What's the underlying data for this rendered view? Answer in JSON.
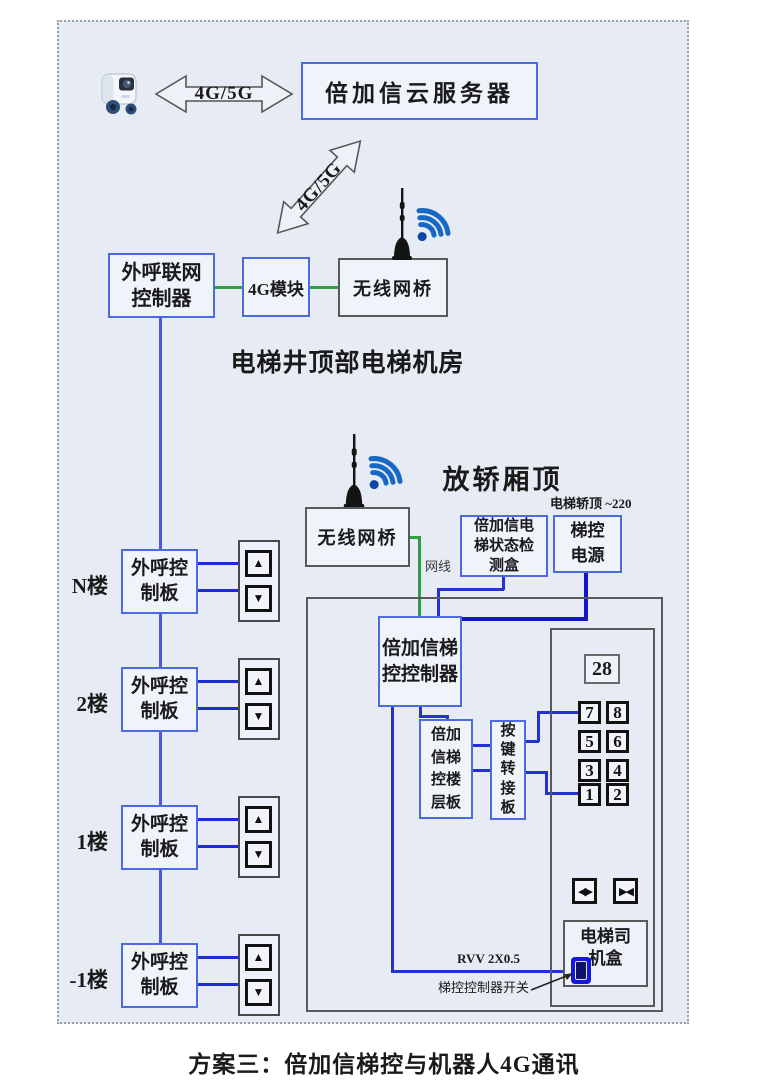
{
  "caption": "方案三：倍加信梯控与机器人4G通讯",
  "cloud": {
    "robot_icon": "delivery-robot-icon",
    "link_label": "4G/5G",
    "server_label": "倍加信云服务器",
    "downlink_label": "4G/5G"
  },
  "machine_room": {
    "area_label": "电梯井顶部电梯机房",
    "call_gateway": "外呼联网\n控制器",
    "module_4g": "4G模块",
    "bridge": "无线网桥",
    "antenna_icon": "antenna-icon",
    "wifi_icon": "wifi-icon"
  },
  "hall": {
    "floors": [
      {
        "label": "N楼",
        "board": "外呼控\n制板",
        "up": "▲",
        "down": "▼"
      },
      {
        "label": "2楼",
        "board": "外呼控\n制板",
        "up": "▲",
        "down": "▼"
      },
      {
        "label": "1楼",
        "board": "外呼控\n制板",
        "up": "▲",
        "down": "▼"
      },
      {
        "label": "-1楼",
        "board": "外呼控\n制板",
        "up": "▲",
        "down": "▼"
      }
    ]
  },
  "car_top": {
    "area_label": "放轿厢顶",
    "bridge": "无线网桥",
    "power_note": "电梯轿顶 ~220",
    "detector": "倍加信电\n梯状态检\n测盒",
    "power_supply": "梯控\n电源",
    "cable_label": "网线",
    "controller": "倍加信梯\n控控制器",
    "floor_board": "倍加\n信梯\n控楼\n层板",
    "key_adapter": "按\n键\n转\n接\n板",
    "panel": {
      "display": "28",
      "buttons": [
        [
          "7",
          "8"
        ],
        [
          "5",
          "6"
        ],
        [
          "3",
          "4"
        ],
        [
          "1",
          "2"
        ]
      ],
      "door_open": "◀▶",
      "door_close": "▶◀",
      "operator_box": "电梯司\n机盒"
    },
    "wire_label": "RVV 2X0.5",
    "switch_label": "梯控控制器开关"
  },
  "colors": {
    "area_bg": "#e7ecf4",
    "border_blue": "#4d6be0",
    "border_gray": "#595959",
    "wire_green": "#2f9e44",
    "wire_blue": "#2531d4",
    "power_blue": "#1414cc",
    "riser_blue": "#4a58e0",
    "wifi_blue": "#1668c4"
  }
}
